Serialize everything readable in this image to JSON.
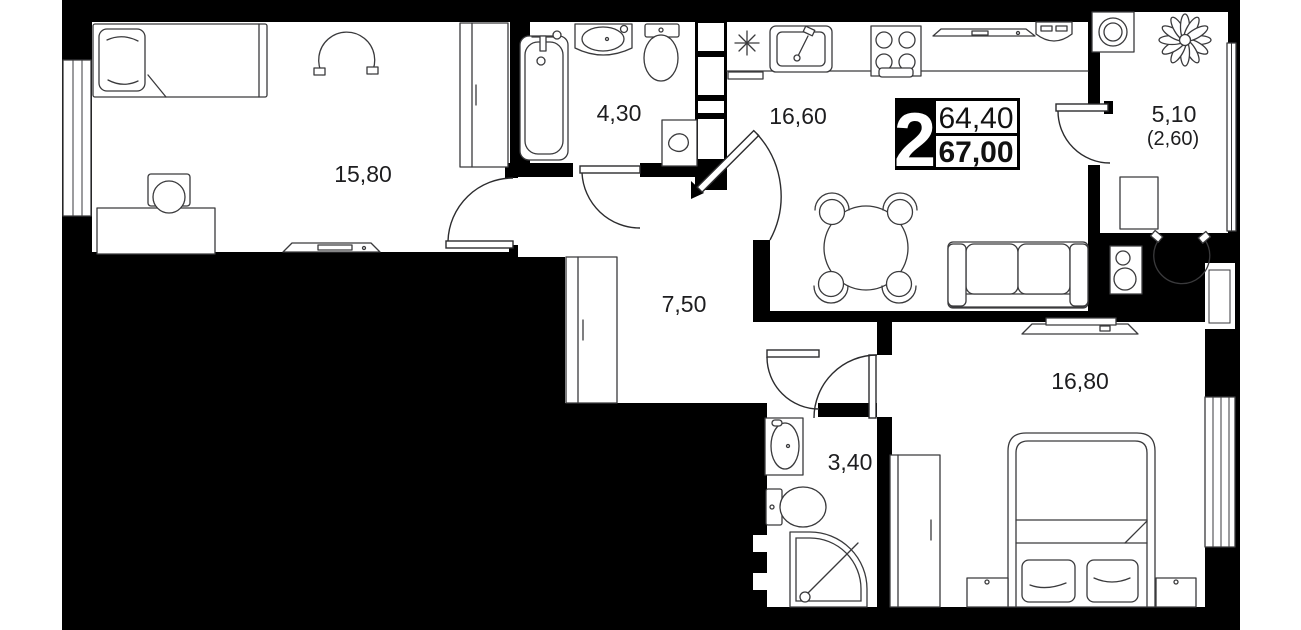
{
  "apartment_plan": {
    "badge": {
      "rooms_count": "2",
      "area_top": "64,40",
      "area_bottom": "67,00"
    },
    "rooms": [
      {
        "name": "bedroom-1",
        "area_label": "15,80"
      },
      {
        "name": "bathroom-1",
        "area_label": "4,30"
      },
      {
        "name": "kitchen-living",
        "area_label": "16,60"
      },
      {
        "name": "balcony",
        "area_label": "5,10",
        "area_label_secondary": "(2,60)"
      },
      {
        "name": "hallway",
        "area_label": "7,50"
      },
      {
        "name": "bathroom-2",
        "area_label": "3,40"
      },
      {
        "name": "bedroom-2",
        "area_label": "16,80"
      }
    ],
    "icons": {
      "ventilation": "eight-spoke-asterisk",
      "plant": "flower-rosette"
    },
    "colors": {
      "background": "#000000",
      "floor": "#ffffff",
      "furniture_line": "#3a3a3c",
      "label_text": "#1d1d1f"
    }
  }
}
